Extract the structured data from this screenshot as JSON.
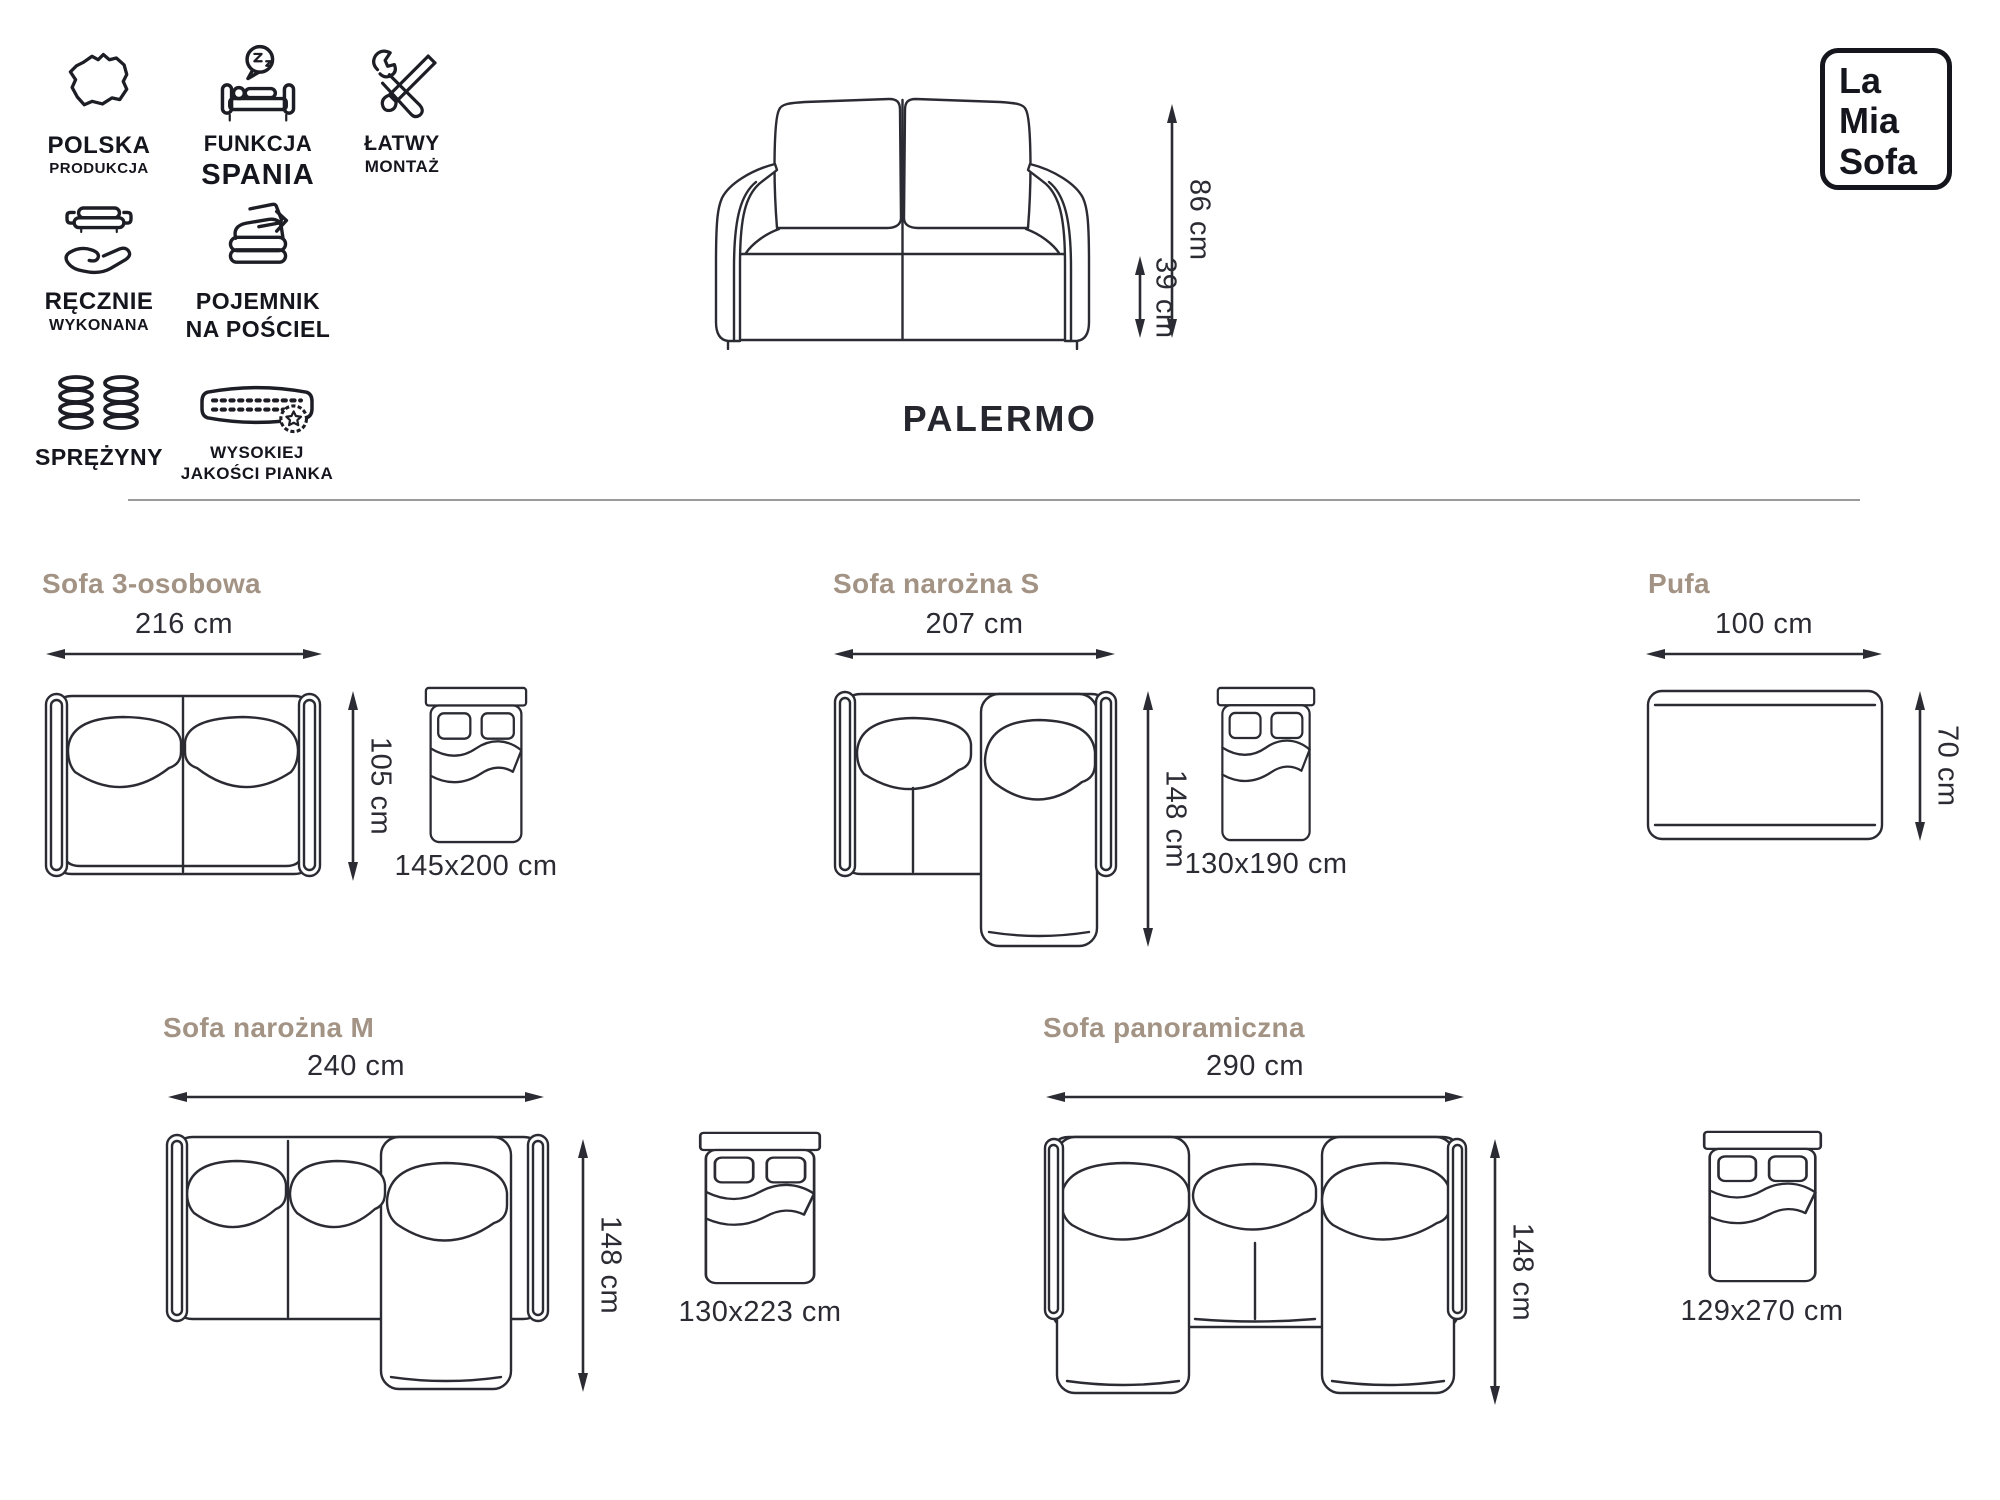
{
  "title": "PALERMO",
  "logo": {
    "line1": "La",
    "line2": "Mia",
    "line3": "Sofa"
  },
  "badges": {
    "polska": {
      "line1": "POLSKA",
      "line2": "PRODUKCJA"
    },
    "funkcja": {
      "line1": "FUNKCJA",
      "line2": "SPANIA"
    },
    "latwy": {
      "line1": "ŁATWY",
      "line2": "MONTAŻ"
    },
    "recznie": {
      "line1": "RĘCZNIE",
      "line2": "WYKONANA"
    },
    "pojemnik": {
      "line1": "POJEMNIK",
      "line2": "NA POŚCIEL"
    },
    "sprezyny": {
      "line1": "SPRĘŻYNY"
    },
    "pianka": {
      "line1": "WYSOKIEJ",
      "line2": "JAKOŚCI PIANKA"
    }
  },
  "hero": {
    "total_height": "86 cm",
    "seat_height": "39 cm"
  },
  "variants": [
    {
      "name": "Sofa 3-osobowa",
      "width": "216 cm",
      "depth": "105 cm",
      "bed": "145x200 cm"
    },
    {
      "name": "Sofa narożna S",
      "width": "207 cm",
      "depth": "148 cm",
      "bed": "130x190 cm"
    },
    {
      "name": "Pufa",
      "width": "100 cm",
      "depth": "70 cm"
    },
    {
      "name": "Sofa narożna M",
      "width": "240 cm",
      "depth": "148 cm",
      "bed": "130x223 cm"
    },
    {
      "name": "Sofa panoramiczna",
      "width": "290 cm",
      "depth": "148 cm",
      "bed": "129x270 cm"
    }
  ],
  "colors": {
    "ink": "#2b2b33",
    "heading": "#a39384",
    "divider": "#9a9a9a"
  }
}
